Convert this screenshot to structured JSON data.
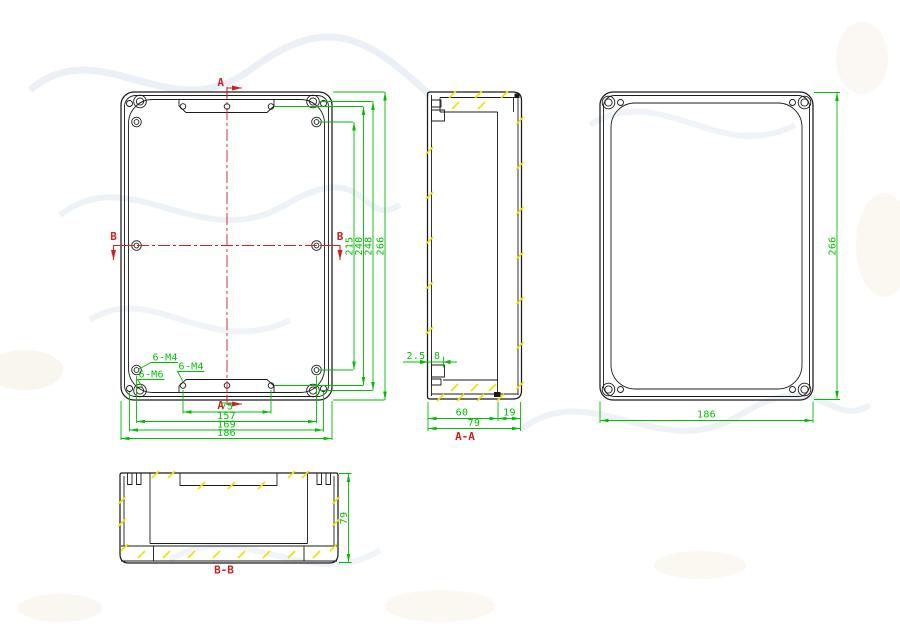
{
  "front": {
    "mark_a": "A",
    "mark_b": "B",
    "leader_m4_corner": "6-M4",
    "leader_m6_corner": "6-M6",
    "leader_m4_plate": "6-M4",
    "dims": {
      "v215": "215",
      "v240": "240",
      "v248": "248",
      "v266": "266",
      "h75": "75",
      "h157": "157",
      "h169": "169",
      "h186": "186"
    }
  },
  "section_aa": {
    "label": "A-A",
    "dims": {
      "wall": "2.5",
      "step": "8",
      "inner": "60",
      "lid": "19",
      "total": "79"
    }
  },
  "back": {
    "dims": {
      "height": "266",
      "width": "186"
    }
  },
  "section_bb": {
    "label": "B-B",
    "dims": {
      "height": "79"
    }
  },
  "colors": {
    "line": "#1b1b1b",
    "dimension": "#00bf00",
    "annotation": "#cf2121",
    "hatch": "#ece400"
  }
}
